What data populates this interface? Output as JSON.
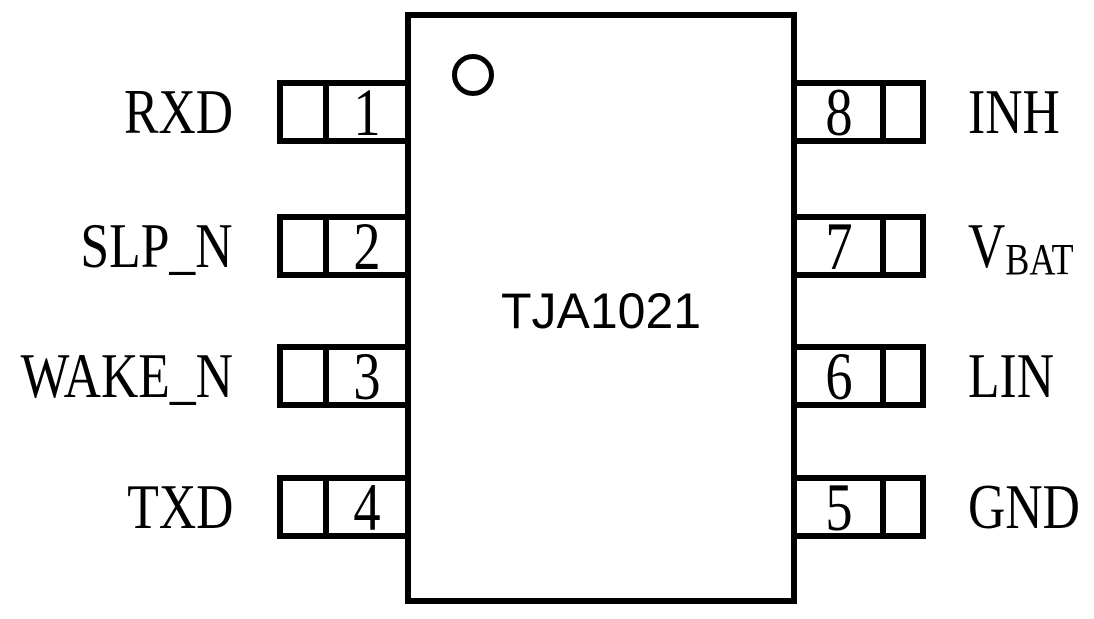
{
  "chip": {
    "name": "TJA1021",
    "package_pin_count": 8
  },
  "pins": [
    {
      "number": "1",
      "name": "RXD",
      "side": "left",
      "row": 0
    },
    {
      "number": "2",
      "name": "SLP_N",
      "side": "left",
      "row": 1
    },
    {
      "number": "3",
      "name": "WAKE_N",
      "side": "left",
      "row": 2
    },
    {
      "number": "4",
      "name": "TXD",
      "side": "left",
      "row": 3
    },
    {
      "number": "8",
      "name": "INH",
      "side": "right",
      "row": 0
    },
    {
      "number": "7",
      "name": "V",
      "name_sub": "BAT",
      "side": "right",
      "row": 1
    },
    {
      "number": "6",
      "name": "LIN",
      "side": "right",
      "row": 2
    },
    {
      "number": "5",
      "name": "GND",
      "side": "right",
      "row": 3
    }
  ],
  "markers": {
    "pin1_indicator": "circle-dot"
  },
  "colors": {
    "line": "#000000",
    "background": "#ffffff",
    "text": "#000000"
  }
}
